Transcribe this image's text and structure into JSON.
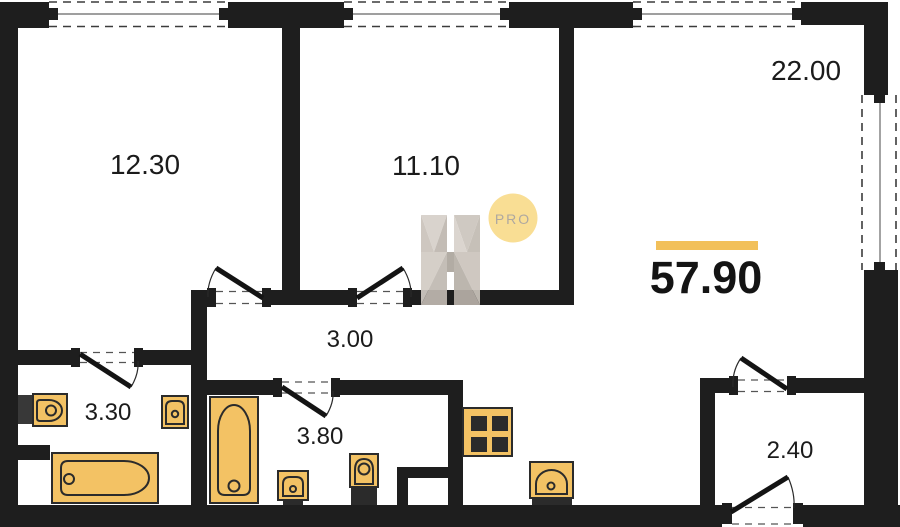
{
  "plan": {
    "total_area": "57.90",
    "rooms": [
      {
        "id": "bedroom-1",
        "area": "12.30"
      },
      {
        "id": "bedroom-2",
        "area": "11.10"
      },
      {
        "id": "living-kitchen",
        "area": "22.00"
      },
      {
        "id": "hallway",
        "area": "3.00"
      },
      {
        "id": "bathroom",
        "area": "3.30"
      },
      {
        "id": "wc-laundry",
        "area": "3.80"
      },
      {
        "id": "entry",
        "area": "2.40"
      }
    ],
    "watermark": {
      "letter": "H",
      "badge": "PRO"
    },
    "icons": [
      "bathtub-icon",
      "toilet-icon",
      "sink-icon",
      "stove-icon",
      "door-swing-icon",
      "window-icon"
    ],
    "colors": {
      "wall": "#1e1e1e",
      "fixture_fill": "#F3C264",
      "fixture_stroke": "#2b2b2b",
      "accent_bar": "#F2C05A",
      "badge_fill": "#F9DC8C",
      "badge_text": "#A8A198",
      "watermark_gray": "#C7C0B8"
    }
  }
}
